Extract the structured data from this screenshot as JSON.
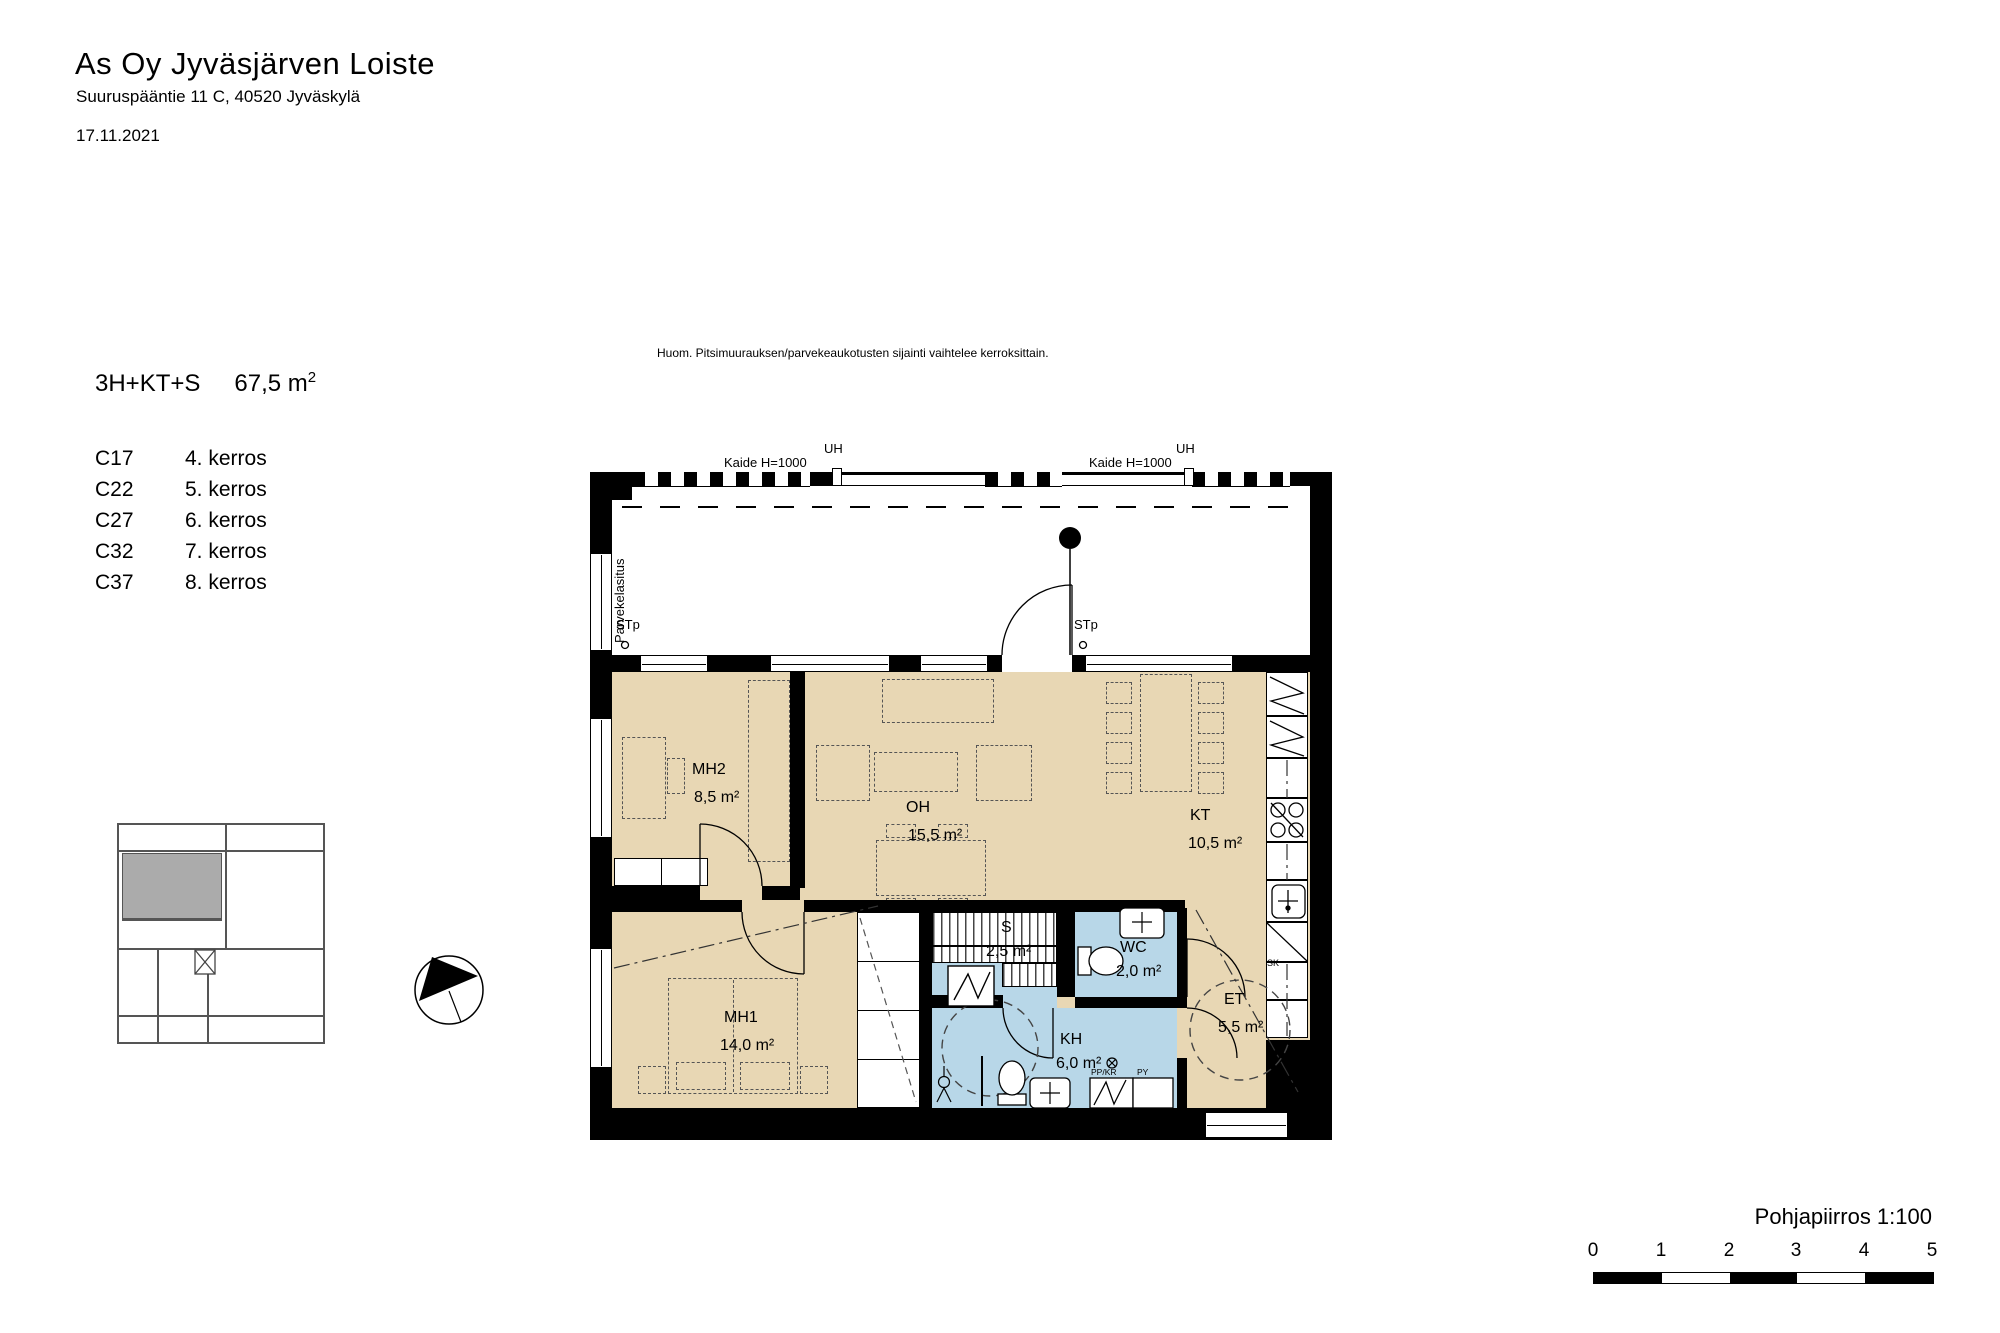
{
  "header": {
    "title": "As Oy Jyväsjärven Loiste",
    "address": "Suuruspääntie 11 C, 40520 Jyväskylä",
    "date": "17.11.2021"
  },
  "note": "Huom. Pitsimuurauksen/parvekeaukotusten sijainti vaihtelee kerroksittain.",
  "apartment": {
    "type": "3H+KT+S",
    "area_value": "67,5 m",
    "area_sup": "2",
    "units": [
      {
        "id": "C17",
        "floor": "4. kerros"
      },
      {
        "id": "C22",
        "floor": "5. kerros"
      },
      {
        "id": "C27",
        "floor": "6. kerros"
      },
      {
        "id": "C32",
        "floor": "7. kerros"
      },
      {
        "id": "C37",
        "floor": "8. kerros"
      }
    ]
  },
  "plan": {
    "rooms": [
      {
        "name": "MH2",
        "area": "8,5 m²"
      },
      {
        "name": "OH",
        "area": "15,5 m²"
      },
      {
        "name": "KT",
        "area": "10,5 m²"
      },
      {
        "name": "MH1",
        "area": "14,0 m²"
      },
      {
        "name": "S",
        "area": "2,5 m²"
      },
      {
        "name": "WC",
        "area": "2,0 m²"
      },
      {
        "name": "KH",
        "area": "6,0 m²"
      },
      {
        "name": "ET",
        "area": "5,5 m²"
      }
    ],
    "annotations": {
      "kaide_left": "Kaide H=1000",
      "kaide_right": "Kaide H=1000",
      "uh_left": "UH",
      "uh_right": "UH",
      "stp_left": "STp",
      "stp_right": "STp",
      "parvekelasitus": "Parvekelasitus",
      "sk": "SK",
      "pp_kr": "PP/KR",
      "py": "PY"
    },
    "colors": {
      "room_fill": "#e8d7b4",
      "wet_room_fill": "#b8d7e8",
      "wall": "#000000",
      "keyplan_highlight": "#ababab"
    }
  },
  "footer": {
    "plan_title": "Pohjapiirros 1:100",
    "scale_ticks": [
      "0",
      "1",
      "2",
      "3",
      "4",
      "5"
    ]
  }
}
